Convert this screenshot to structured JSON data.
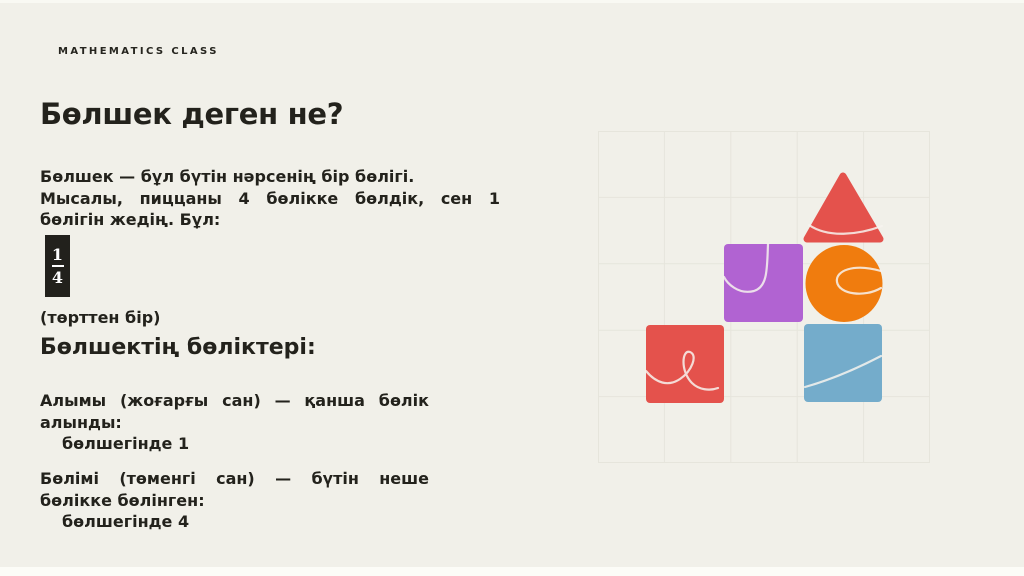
{
  "kicker": "MATHEMATICS CLASS",
  "title": "Бөлшек деген не?",
  "intro": {
    "line1": "Бөлшек — бұл бүтін нәрсенің бір бөлігі.",
    "line2": "Мысалы, пиццаны 4 бөлікке бөлдік, сен 1 бөлігін жедің. Бұл:"
  },
  "fraction": {
    "numerator": "1",
    "denominator": "4",
    "caption": "(төрттен бір)"
  },
  "parts": {
    "heading": "Бөлшектің бөліктері:",
    "numerator_desc": "Алымы (жоғарғы сан) — қанша бөлік алынды:",
    "numerator_example": "бөлшегінде 1",
    "denominator_desc": "Бөлімі (төменгі сан) — бүтін неше бөлікке бөлінген:",
    "denominator_example": "бөлшегінде 4"
  },
  "graphic": {
    "grid": {
      "columns": 5,
      "rows": 5,
      "cell_size_px": 66,
      "line_color": "#e6e5dc"
    },
    "shapes": [
      {
        "name": "red-triangle",
        "type": "triangle",
        "color": "#e4524c"
      },
      {
        "name": "purple-square",
        "type": "square",
        "color": "#b163d2"
      },
      {
        "name": "orange-circle",
        "type": "circle",
        "color": "#f07c0e"
      },
      {
        "name": "red-square",
        "type": "square",
        "color": "#e4524c"
      },
      {
        "name": "blue-square",
        "type": "square",
        "color": "#74accb"
      }
    ]
  },
  "palette": {
    "background": "#f1f0e9",
    "text": "#23221c",
    "grid_line": "#e6e5dc",
    "fraction_box_bg": "#22211c",
    "fraction_box_text": "#ffffff",
    "squiggle": "#f7f3ee"
  }
}
